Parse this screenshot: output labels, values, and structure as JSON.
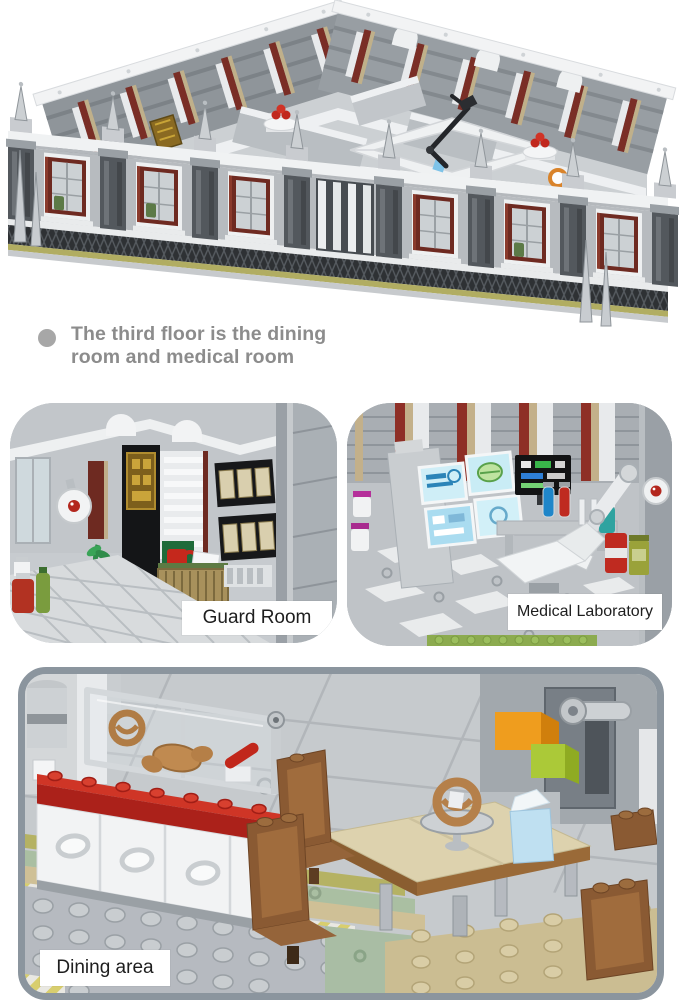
{
  "caption": {
    "text": "The third floor is the dining room and medical room"
  },
  "labels": {
    "guard_room": "Guard Room",
    "medical_laboratory": "Medical Laboratory",
    "dining_area": "Dining area"
  },
  "scenes": {
    "hero": "third-floor-building-model",
    "left_panel": "guard-room-interior",
    "right_panel": "medical-laboratory-interior",
    "bottom_panel": "dining-area-interior"
  },
  "colors": {
    "background": "#ffffff",
    "caption_text": "#8c8c8c",
    "caption_bullet": "#a7a7a7",
    "label_text": "#1e1e1e",
    "label_background": "#ffffff",
    "panel_border": "#8b959e",
    "lego_red": "#c02c22",
    "lego_dark_red_window": "#6e2a21",
    "lego_olive": "#b1ad62",
    "lego_brown": "#8a5a33",
    "lego_tan": "#cfc096",
    "brick_gray": "#b7bbbf",
    "screen_cyan": "#cfeef7",
    "cup_blue": "#bfe0f1",
    "box_orange": "#ef9d1e",
    "box_lime": "#abc938"
  }
}
